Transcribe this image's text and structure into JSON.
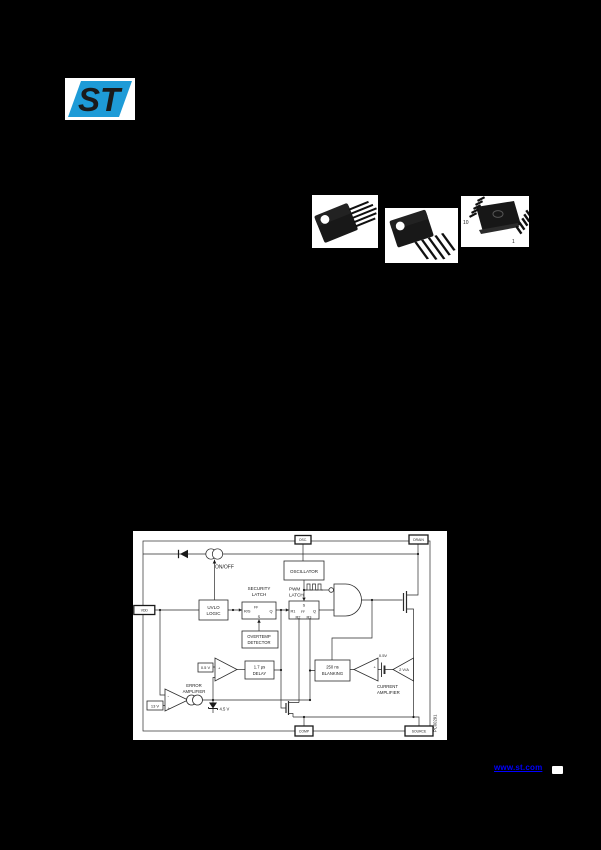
{
  "page": {
    "background": "#000000"
  },
  "logo": {
    "text": "ST",
    "blue": "#1E9BD7"
  },
  "packages": {
    "pso_pin10": "10",
    "pso_pin1": "1"
  },
  "diagram": {
    "pads": {
      "osc": "OSC.",
      "drain": "DRAIN",
      "vdd": "VDD",
      "comp": "COMP",
      "source": "SOURCE"
    },
    "oscillator": "OSCILLATOR",
    "uvlo": [
      "UVLO",
      "LOGIC"
    ],
    "security": [
      "SECURITY",
      "LATCH"
    ],
    "pwm": [
      "PWM",
      "LATCH"
    ],
    "overtemp": [
      "OVERTEMP",
      "DETECTOR"
    ],
    "delay": [
      "1.7 μs",
      "DELAY"
    ],
    "blanking": [
      "250 ns",
      "BLANKING"
    ],
    "latch": {
      "rs": "R/S",
      "ff": "FF",
      "q": "Q",
      "s": "S",
      "r1": "R1",
      "r2": "R2",
      "r3": "R3"
    },
    "labels": {
      "onoff": "ON/OFF",
      "error": [
        "ERROR",
        "AMPLIFIER"
      ],
      "current": [
        "CURRENT",
        "AMPLIFIER"
      ],
      "ref05box": "0.5 V",
      "v13": "13 V",
      "zener": "4.5 V",
      "bat05": "0.5V",
      "gain": "2 V/A",
      "plus": "+",
      "minus": "-",
      "code": "PC00291"
    }
  },
  "footer": {
    "link": "www.st.com"
  }
}
